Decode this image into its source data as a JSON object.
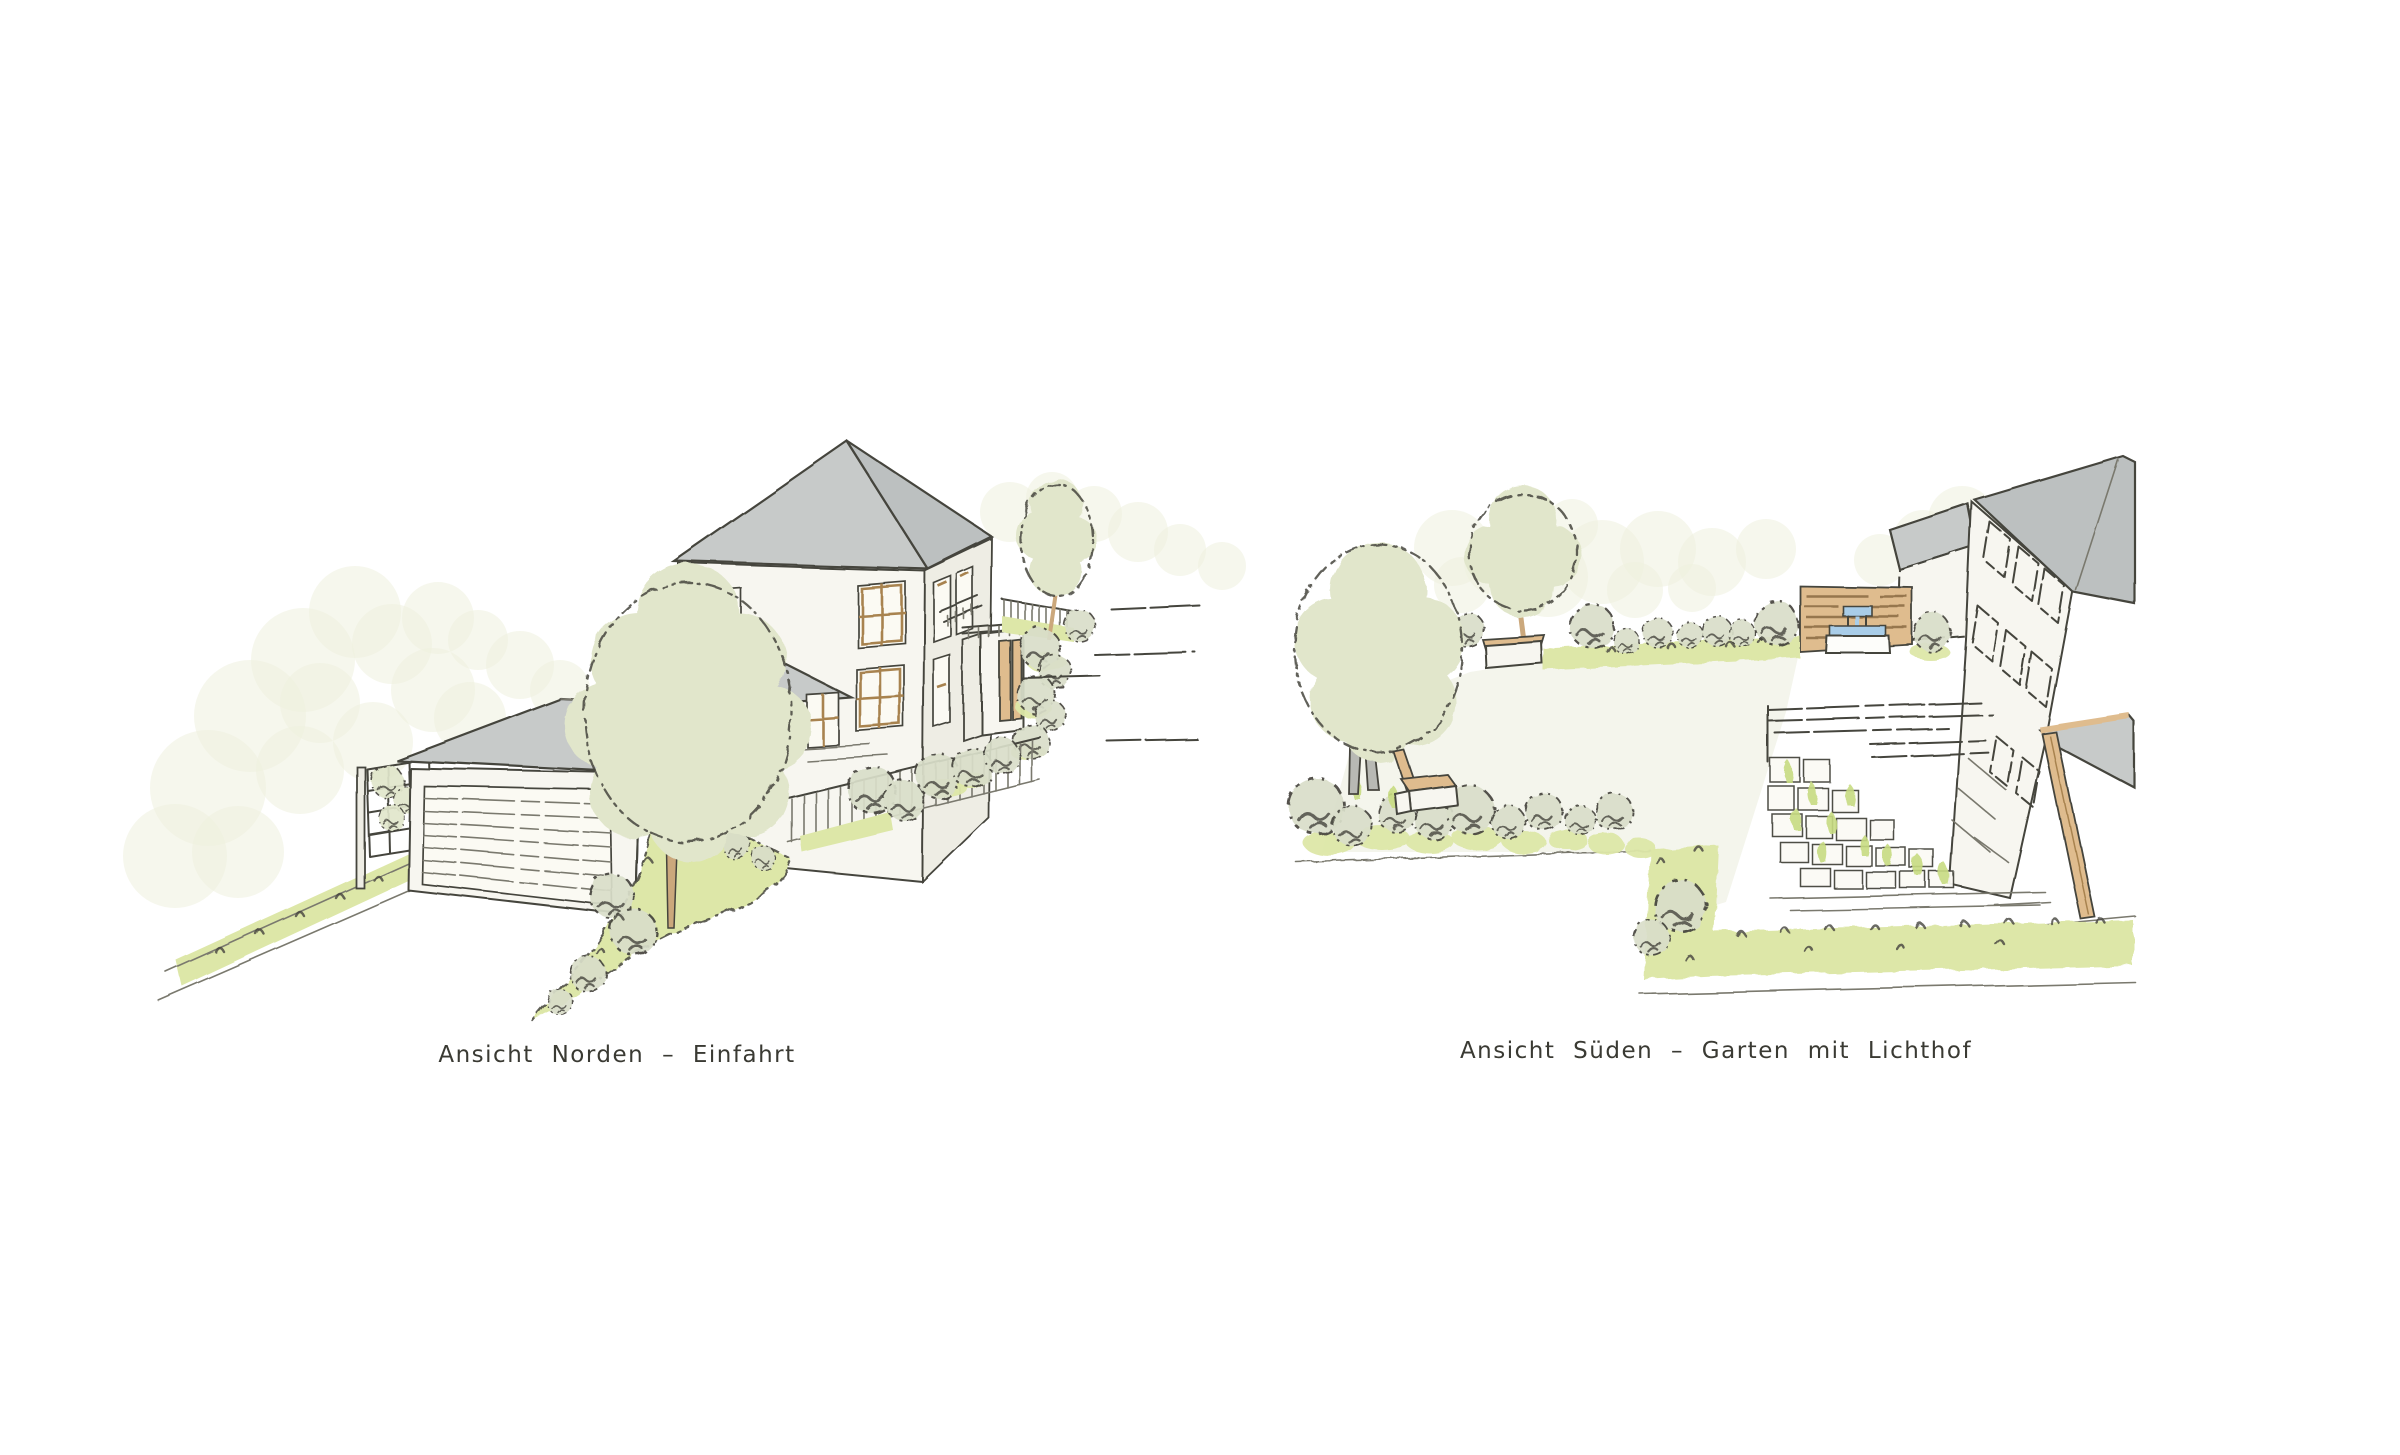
{
  "page": {
    "background": "#ffffff",
    "type": "architectural-sketch-sheet"
  },
  "panels": {
    "north": {
      "caption": "Ansicht Norden – Einfahrt"
    },
    "south": {
      "caption": "Ansicht Süden – Garten mit Lichthof"
    }
  },
  "colors": {
    "ink": "#45443d",
    "inkSoft": "#7a796e",
    "paper": "#ffffff",
    "wall": "#f7f6f0",
    "wallShade": "#eeede4",
    "roof": "#c7cac9",
    "roofDark": "#bcc0c0",
    "foliage": "#e1e6cb",
    "sage": "#d9dec9",
    "grass": "#dde7a8",
    "grassBright": "#c8dc82",
    "bokeh": "#eef0df",
    "wood": "#dfbc8e",
    "woodDark": "#a8834f",
    "trunk": "#cba87c",
    "trunkGray": "#b8b9b4",
    "water": "#a9cde8"
  }
}
